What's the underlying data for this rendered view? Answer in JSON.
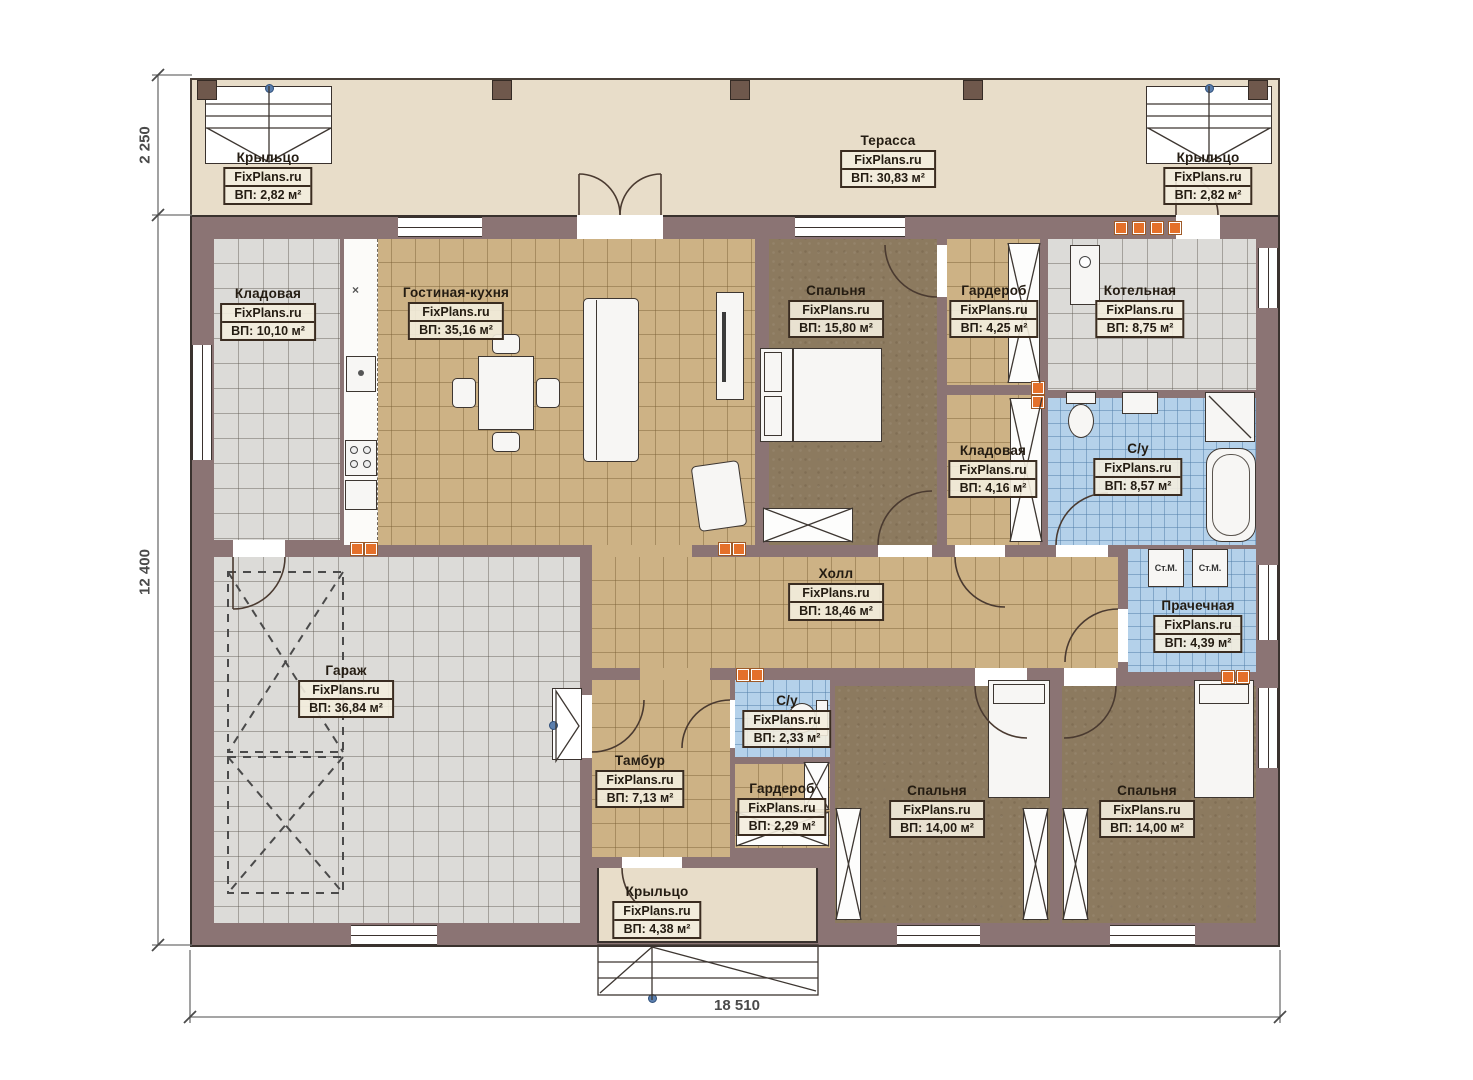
{
  "brand": "FixPlans.ru",
  "dimensions": {
    "terrace_depth": "2 250",
    "house_depth": "12 400",
    "house_width": "18 510"
  },
  "labels": {
    "washer": "Ст.М.",
    "sink_mark": "×"
  },
  "rooms": [
    {
      "id": "porch-left",
      "name": "Крыльцо",
      "site": "FixPlans.ru",
      "area": "ВП: 2,82 м²"
    },
    {
      "id": "terrace",
      "name": "Терасса",
      "site": "FixPlans.ru",
      "area": "ВП: 30,83 м²"
    },
    {
      "id": "porch-right",
      "name": "Крыльцо",
      "site": "FixPlans.ru",
      "area": "ВП: 2,82 м²"
    },
    {
      "id": "storage-1",
      "name": "Кладовая",
      "site": "FixPlans.ru",
      "area": "ВП: 10,10 м²"
    },
    {
      "id": "living-kitchen",
      "name": "Гостиная-кухня",
      "site": "FixPlans.ru",
      "area": "ВП: 35,16 м²"
    },
    {
      "id": "bedroom-1",
      "name": "Спальня",
      "site": "FixPlans.ru",
      "area": "ВП: 15,80 м²"
    },
    {
      "id": "wardrobe-1",
      "name": "Гардероб",
      "site": "FixPlans.ru",
      "area": "ВП: 4,25 м²"
    },
    {
      "id": "boiler-room",
      "name": "Котельная",
      "site": "FixPlans.ru",
      "area": "ВП: 8,75 м²"
    },
    {
      "id": "storage-2",
      "name": "Кладовая",
      "site": "FixPlans.ru",
      "area": "ВП: 4,16 м²"
    },
    {
      "id": "bathroom-1",
      "name": "С/у",
      "site": "FixPlans.ru",
      "area": "ВП: 8,57 м²"
    },
    {
      "id": "hall",
      "name": "Холл",
      "site": "FixPlans.ru",
      "area": "ВП: 18,46 м²"
    },
    {
      "id": "laundry",
      "name": "Прачечная",
      "site": "FixPlans.ru",
      "area": "ВП: 4,39 м²"
    },
    {
      "id": "garage",
      "name": "Гараж",
      "site": "FixPlans.ru",
      "area": "ВП: 36,84 м²"
    },
    {
      "id": "tambour",
      "name": "Тамбур",
      "site": "FixPlans.ru",
      "area": "ВП: 7,13 м²"
    },
    {
      "id": "bathroom-2",
      "name": "С/у",
      "site": "FixPlans.ru",
      "area": "ВП: 2,33 м²"
    },
    {
      "id": "wardrobe-2",
      "name": "Гардероб",
      "site": "FixPlans.ru",
      "area": "ВП: 2,29 м²"
    },
    {
      "id": "bedroom-2",
      "name": "Спальня",
      "site": "FixPlans.ru",
      "area": "ВП: 14,00 м²"
    },
    {
      "id": "bedroom-3",
      "name": "Спальня",
      "site": "FixPlans.ru",
      "area": "ВП: 14,00 м²"
    },
    {
      "id": "porch-bottom",
      "name": "Крыльцо",
      "site": "FixPlans.ru",
      "area": "ВП: 4,38 м²"
    }
  ]
}
